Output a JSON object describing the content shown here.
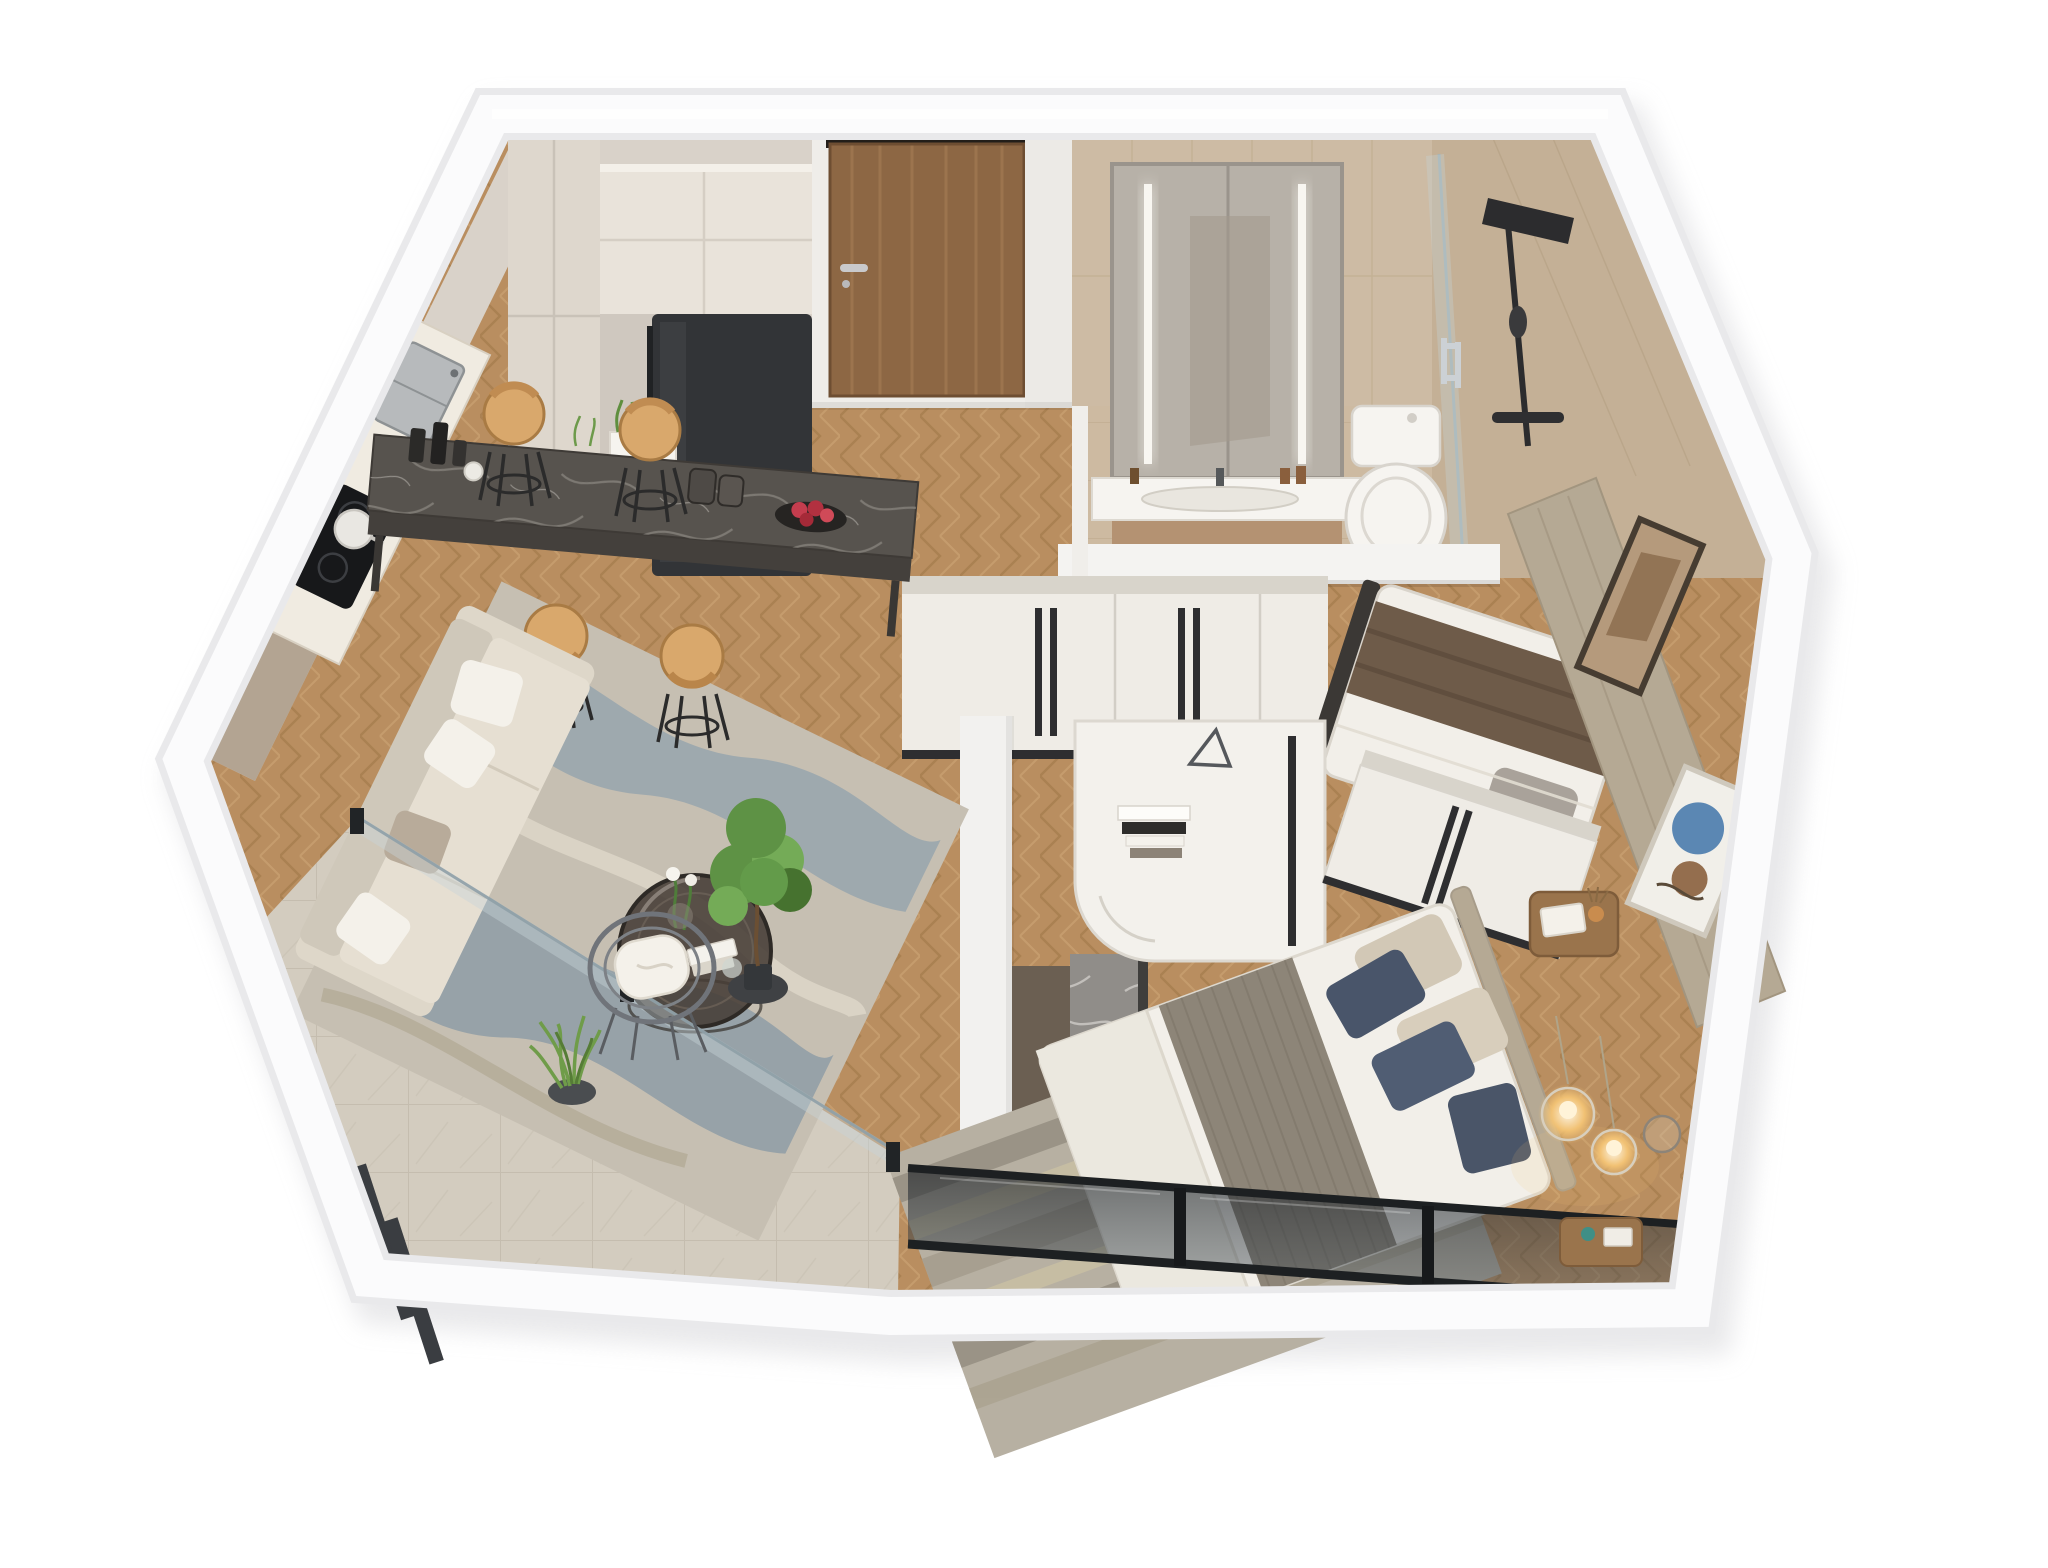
{
  "meta": {
    "title": "3D isometric cutaway floor plan render of a one-bedroom-plus-study apartment",
    "view": "isometric 3D dollhouse cutaway, viewed from above",
    "background": "#ffffff"
  },
  "palette": {
    "wall_outer": "#e9e9eb",
    "wall_face": "#fbfbfc",
    "wall_cream": "#d9d2c9",
    "wall_taupe": "#b3a492",
    "wall_white": "#efede9",
    "wood_base": "#b98e60",
    "wood_seam_dark": "#9e7747",
    "wood_seam_light": "#cfa878",
    "tile_bath": "#cdbaa1",
    "tile_bath_seam": "#b5a183",
    "tile_balcony": "#d3ccbf",
    "tile_balcony_seam": "#bfb7a8",
    "door_wood": "#8d6744",
    "door_wood_light": "#a67e55",
    "fridge": "#323437",
    "cabinet_cream": "#e9e3da",
    "cabinet_tall": "#ded7cd",
    "counter_white": "#f0ebe1",
    "bar_marble": "#57534e",
    "bar_marble_vein": "#9d9892",
    "stool_seat": "#d9a86c",
    "stool_leg": "#2b2b2b",
    "sofa_body": "#e6dfd2",
    "sofa_back": "#cfc8ba",
    "pillow_white": "#f4f1ea",
    "pillow_taupe": "#b8ab9a",
    "rug_living": "#c6bfb2",
    "rug_blue": "#7e98ab",
    "rug_blue_deep": "#5d7f9b",
    "table_glass": "#453c35",
    "mirror": "#b7b1a8",
    "led_strip": "#f8f6f1",
    "vanity_wood": "#b49272",
    "ceramic_white": "#f6f4f0",
    "shower_black": "#2c2c2e",
    "glass_tint": "#c7d3d8",
    "chrome": "#ccd1d5",
    "wardrobe_front": "#efece6",
    "wardrobe_top": "#d8d4cb",
    "handle_black": "#2e2e30",
    "bed_white": "#f2efe9",
    "blanket_brown": "#6e5b49",
    "pillow_grey": "#a9a29a",
    "runner_grey": "#8d8578",
    "pillow_navy": "#49556a",
    "pillow_beige": "#d2c8b6",
    "headboard_taupe": "#b5a994",
    "art_frame": "#42382e",
    "art_blue": "#4e7eae",
    "art_brown": "#8a5f3d",
    "art_warm": "#b59a7c",
    "nightstand_wood": "#9a744c",
    "pendant_warm": "#f4c475",
    "marble_grey": "#908d89",
    "marble_grey_vein": "#d8d5d1",
    "niche_dark": "#6b5f52",
    "window_glass": "#2a3038",
    "window_frame": "#1d2022",
    "rug_master": "#b7b0a2",
    "rug_master_warm": "#c9c0a4",
    "rug_master_dark": "#958f82",
    "plant_green": "#5e9245",
    "plant_green_dark": "#46722f",
    "plant_pot": "#3f4144",
    "louver_dark": "#3a3d41"
  },
  "materials": {
    "main_floor": "oak chevron herringbone parquet",
    "bathroom_floor": "beige ceramic tile",
    "balcony_floor": "beige marble tile",
    "bar_top": "dark grey veined marble",
    "tv_pier": "grey veined marble"
  },
  "rooms": [
    {
      "id": "kitchen",
      "label": "Kitchen",
      "furniture": [
        "tall cabinet",
        "upper cabinets",
        "black refrigerator",
        "countertop with sink",
        "induction cooktop with pot",
        "herb planters"
      ]
    },
    {
      "id": "entry",
      "label": "Entry",
      "furniture": [
        "wooden entry door with handle"
      ]
    },
    {
      "id": "bathroom",
      "label": "Bathroom",
      "furniture": [
        "mirror cabinet with LED strips",
        "vanity with sink and bottles",
        "toilet",
        "walk-in shower with black fixture",
        "glass shower door with chrome handle"
      ]
    },
    {
      "id": "hallway",
      "label": "Hallway",
      "furniture": [
        "white wardrobe cabinets with black handles"
      ]
    },
    {
      "id": "kids-bedroom",
      "label": "Second Bedroom",
      "furniture": [
        "single bed with brown blanket and grey pillow",
        "framed wall art"
      ]
    },
    {
      "id": "master-bedroom",
      "label": "Master Bedroom",
      "furniture": [
        "double bed with grey runner, navy and beige pillows",
        "upholstered headboard wall with abstract art",
        "white curved desk with books",
        "sliding-door wardrobe",
        "wooden nightstand with magazine and diffuser",
        "glass pendant lights",
        "grey marble TV pier",
        "striped area rug",
        "full-width tinted window wall"
      ]
    },
    {
      "id": "living-room",
      "label": "Living Room",
      "furniture": [
        "cream sofa with cushions",
        "round smoked-glass coffee table with tulips and books",
        "abstract blue area rug",
        "framed abstract wall art",
        "dark marble bar dining table",
        "4 tan bar stools",
        "candle set",
        "bowl of red fruit"
      ]
    },
    {
      "id": "balcony",
      "label": "Balcony",
      "furniture": [
        "wire lounge chair with white cushion",
        "potted ficus tree",
        "potted grass plant",
        "glass partition",
        "glass railing with chrome handrail",
        "dark privacy louvers"
      ]
    }
  ]
}
